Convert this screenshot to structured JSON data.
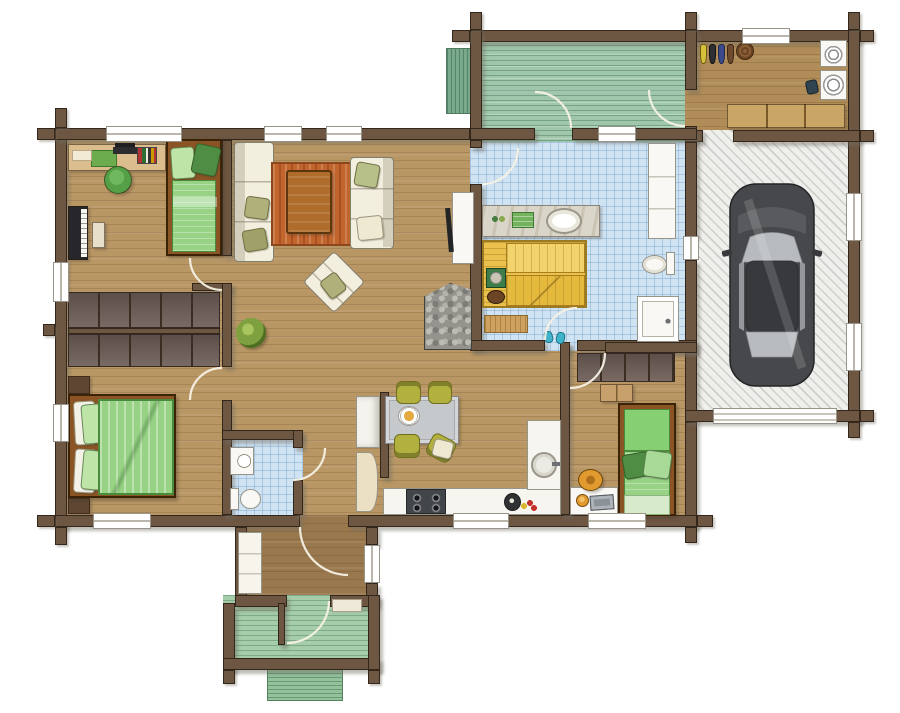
{
  "palette": {
    "wallBrown": "#6d5642",
    "wallEdge": "#33261a",
    "woodMain": "#b99765",
    "hallWood": "#9a784e",
    "mudWood": "#b08c58",
    "bathBlue": "#cfe3f3",
    "garageFloor": "#efefec",
    "deckGreen": "#a0c7ab",
    "porchGreen": "#a5cdaa",
    "stepsTeal": "#79a98c",
    "stepGreen": "#93c29b",
    "carBody": "#47484b",
    "carRoof": "#38393c",
    "carGlass": "#b7bbbe",
    "carEdge": "#222426",
    "sofaCream": "#f3efdf",
    "sofaEdge": "#83806f",
    "oliveCushion": "#b0b07a",
    "rugOrange": "#c2652d",
    "rugEdge": "#8e471c",
    "tableWood": "#b06c2a",
    "bedFrame": "#8a5424",
    "bedGreen": "#98d385",
    "bedGreenLight": "#bfe4a8",
    "bedGreenPale": "#d7ebca",
    "bedGreenDark": "#4f8c44",
    "closet": "#70605a",
    "closetEdge": "#352a23",
    "sauna": "#eac14d",
    "saunaLight": "#f3d36b",
    "saunaEdge": "#9c7a22",
    "heaterGreen": "#3e7c49",
    "bucketBrown": "#6b4423",
    "counterWhite": "#f6f5ef",
    "stoveDark": "#42454a",
    "chairOlive": "#b2b13f",
    "chairOliveEdge": "#6f6f1f",
    "tableGray": "#c5c9cc",
    "chairGreen": "#55a047",
    "chairOrange": "#e09a2d",
    "pianoBlack": "#26262b",
    "deskTan": "#dbbd8e",
    "benchTan": "#c9a566",
    "fixWhite": "#f9f8f4",
    "fixEdge": "#97948a",
    "fridgeWhite": "#f4f3ee",
    "pantryCream": "#ece0c4",
    "plantGreen": "#7fa03f",
    "stoneGray": "#94938d",
    "matTan": "#cfa15f",
    "slipperTeal": "#3fb3c9",
    "arcWhite": "#f6f1e4",
    "dresserTan": "#c7a06b"
  },
  "scene": {
    "type": "residential-floor-plan",
    "view": "top-down",
    "rooms": [
      {
        "name": "kids-bedroom-office",
        "furniture": [
          "desk",
          "office-chair",
          "piano",
          "piano-bench",
          "single-bed"
        ]
      },
      {
        "name": "living-room",
        "furniture": [
          "sofa",
          "sofa",
          "armchair",
          "coffee-table",
          "rug",
          "tv-cabinet",
          "stone-fireplace",
          "potted-plant",
          "wardrobe-row",
          "wardrobe-row"
        ]
      },
      {
        "name": "master-bedroom",
        "furniture": [
          "double-bed",
          "nightstand",
          "nightstand"
        ]
      },
      {
        "name": "sauna-bathroom",
        "furniture": [
          "vanity-counter",
          "sink",
          "towels",
          "sauna-benches",
          "sauna-heater",
          "sauna-bucket",
          "toilet",
          "shower",
          "tall-cabinet",
          "bath-mat",
          "slippers"
        ]
      },
      {
        "name": "small-bathroom",
        "furniture": [
          "washbasin",
          "toilet"
        ]
      },
      {
        "name": "kitchen-dining",
        "furniture": [
          "dining-table",
          "dining-chair",
          "dining-chair",
          "dining-chair",
          "dining-chair",
          "plate-of-food",
          "counter",
          "gas-stove",
          "round-sink",
          "fridge",
          "pantry-cabinet",
          "kettle",
          "fruit"
        ]
      },
      {
        "name": "kids-bedroom-2",
        "furniture": [
          "single-bed",
          "desk",
          "desk-chair",
          "laptop",
          "wardrobe",
          "dresser"
        ]
      },
      {
        "name": "mudroom",
        "furniture": [
          "washer",
          "dryer",
          "bench",
          "shoe-row",
          "basket",
          "watering-can"
        ]
      },
      {
        "name": "garage",
        "furniture": [
          "car"
        ]
      },
      {
        "name": "deck",
        "furniture": [
          "steps"
        ]
      },
      {
        "name": "entry-hall",
        "furniture": [
          "closet"
        ]
      },
      {
        "name": "porch",
        "furniture": [
          "doormat",
          "steps",
          "privacy-screen"
        ]
      }
    ]
  }
}
